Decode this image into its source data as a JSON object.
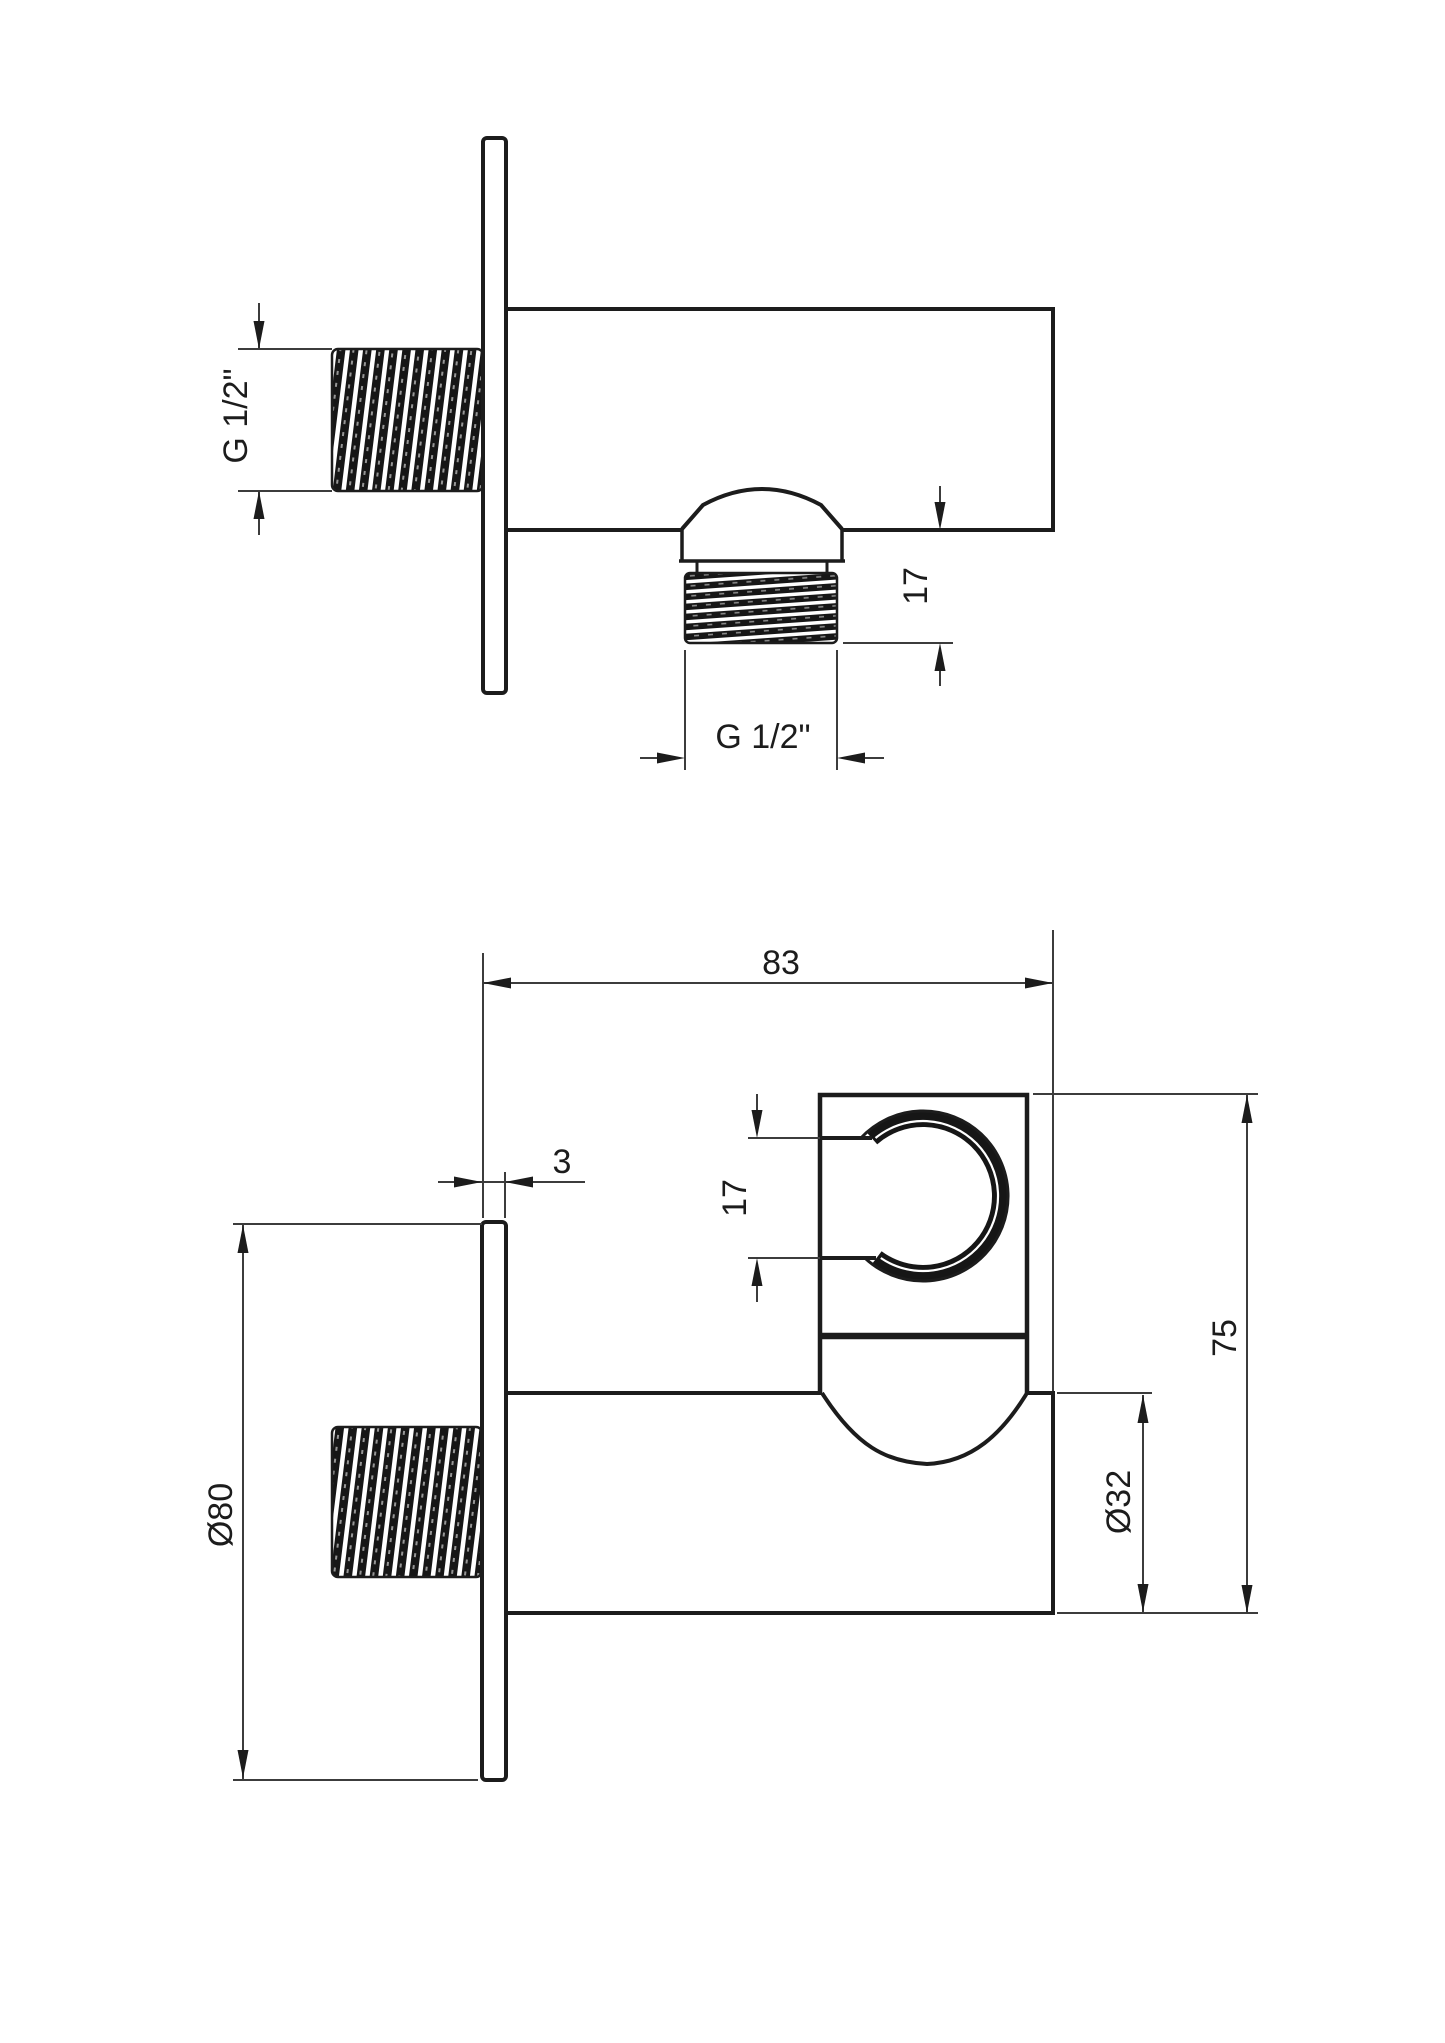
{
  "page": {
    "background": "#ffffff",
    "description": "Technical dimension drawing of a wall-mounted shower outlet elbow with hand-shower holder, two orthographic views"
  },
  "drawing": {
    "units": "mm",
    "stroke_color": "#1c1c1c",
    "thin_line_color": "#3c3c3c",
    "views": {
      "side_view": {
        "title": "side profile view",
        "labels": {
          "wall_thread": "G 1/2\"",
          "outlet_thread": "G 1/2\"",
          "outlet_offset": "17"
        }
      },
      "front_view": {
        "title": "front elevation view",
        "labels": {
          "depth": "83",
          "plate_thickness": "3",
          "holder_slot": "17",
          "total_height": "75",
          "body_diameter": "Ø32",
          "plate_diameter": "Ø80"
        }
      }
    },
    "dimensions_mm": {
      "depth": 83,
      "plate_thickness": 3,
      "holder_slot": 17,
      "total_height": 75,
      "body_diameter": 32,
      "plate_diameter": 80,
      "outlet_offset": 17,
      "wall_thread_spec": "G 1/2\"",
      "outlet_thread_spec": "G 1/2\""
    }
  }
}
